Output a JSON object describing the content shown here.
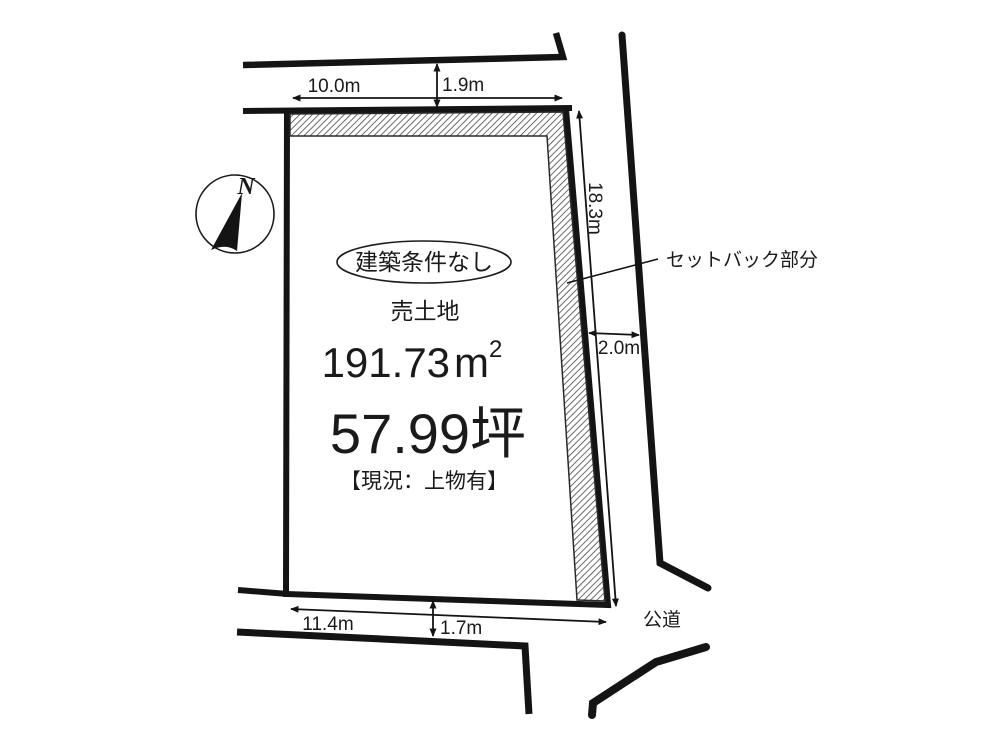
{
  "page": {
    "background": "#ffffff",
    "line_color": "#141414",
    "text_color": "#1a1a1a"
  },
  "compass": {
    "north_label": "N"
  },
  "parcel": {
    "condition_badge": "建築条件なし",
    "property_type": "売土地",
    "area_sqm": {
      "value": "191.73",
      "unit_base": "m",
      "unit_exponent": "2"
    },
    "area_tsubo": "57.99坪",
    "current_status": "【現況：上物有】"
  },
  "annotations": {
    "setback_label": "セットバック部分",
    "public_road_label": "公道"
  },
  "dimensions": {
    "top_width": "10.0m",
    "top_road_width": "1.9m",
    "right_depth": "18.3m",
    "right_road_width": "2.0m",
    "bottom_width": "11.4m",
    "bottom_road_width": "1.7m"
  }
}
